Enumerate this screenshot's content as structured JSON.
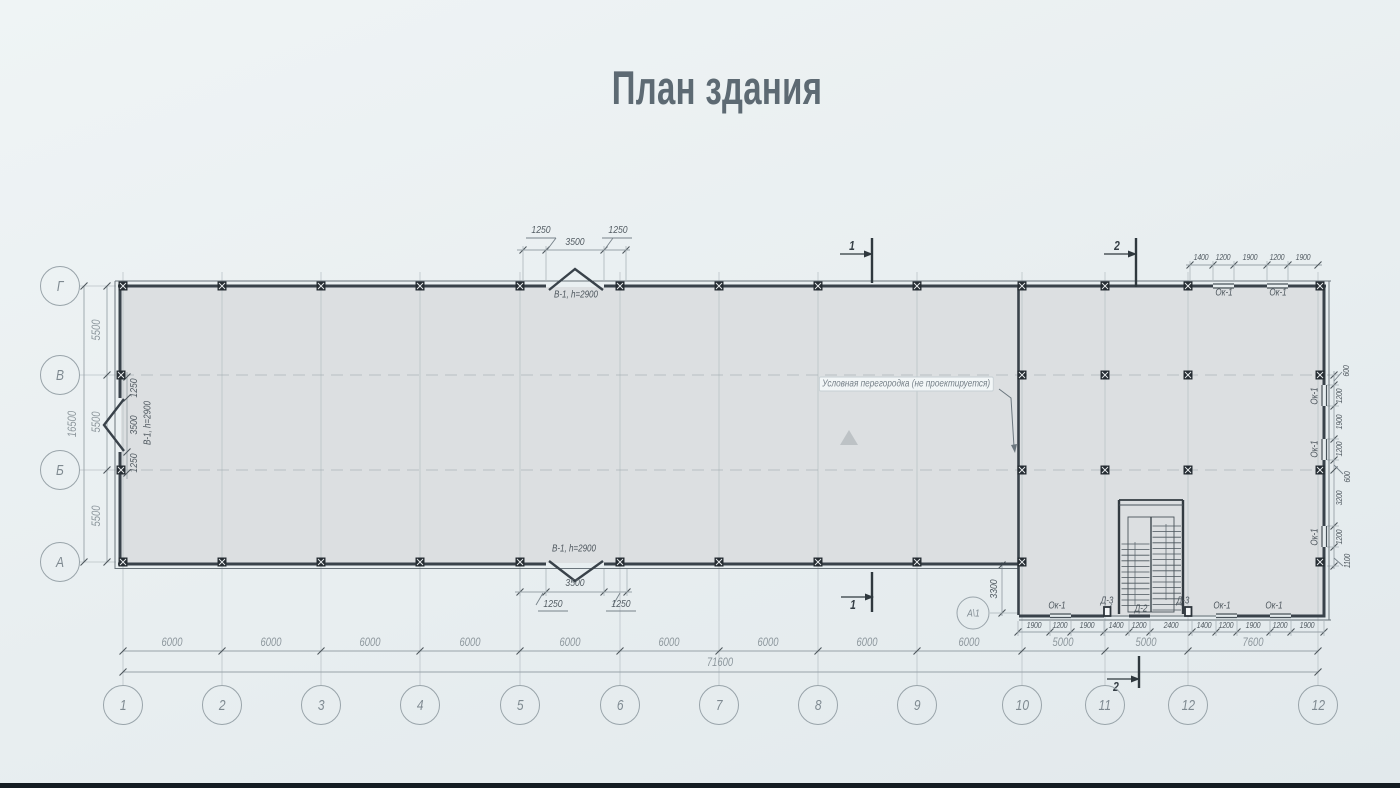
{
  "title": "План здания",
  "colors": {
    "background": "#e8eef0",
    "floor": "#dcdfe1",
    "wall_ink": "#39424a",
    "dim_line": "#98a2a8",
    "dim_text_light": "#8d979d",
    "dim_text_dark": "#535c63",
    "axis_circle": "#99a4aa"
  },
  "axes": {
    "bottom_labels": [
      "1",
      "2",
      "3",
      "4",
      "5",
      "6",
      "7",
      "8",
      "9",
      "10",
      "11",
      "12",
      "12"
    ],
    "left_labels": [
      "Г",
      "В",
      "Б",
      "А"
    ],
    "special": "А\\1"
  },
  "dims": {
    "bottom_spans": [
      "6000",
      "6000",
      "6000",
      "6000",
      "6000",
      "6000",
      "6000",
      "6000",
      "6000",
      "5000",
      "5000",
      "7600"
    ],
    "bottom_total": "71600",
    "bottom_openings": [
      "1900",
      "1200",
      "1900",
      "1400",
      "1200",
      "2400",
      "1400",
      "1200",
      "1900",
      "1200",
      "1900"
    ],
    "left_spans": [
      "5500",
      "5500",
      "5500"
    ],
    "left_total": "16500",
    "top_right_openings": [
      "1400",
      "1200",
      "1900",
      "1200",
      "1900"
    ],
    "right_openings": [
      "600",
      "1200",
      "1900",
      "1200",
      "600",
      "3200",
      "1200",
      "1100"
    ],
    "gate_top": [
      "1250",
      "3500",
      "1250"
    ],
    "gate_bottom": [
      "3500",
      "1250",
      "1250"
    ],
    "gate_left": [
      "1250",
      "3500",
      "1250"
    ],
    "annex_offset": "3300"
  },
  "openings": {
    "gate_top_tag": "В-1, h=2900",
    "gate_bottom_tag": "В-1, h=2900",
    "gate_left_tag": "В-1, h=2900",
    "top_window_tags": [
      "Ок-1",
      "Ок-1"
    ],
    "bottom_wall_tags": [
      "Ок-1",
      "Д-3",
      "Д-2",
      "Д-3",
      "Ок-1",
      "Ок-1"
    ],
    "right_window_tags": [
      "Ок-1",
      "Ок-1",
      "Ок-1"
    ]
  },
  "notes": {
    "partition": "Условная перегородка (не проектируется)"
  },
  "sections": {
    "s1_top": "1",
    "s1_bottom": "1",
    "s2_top": "2",
    "s2_bottom": "2"
  }
}
